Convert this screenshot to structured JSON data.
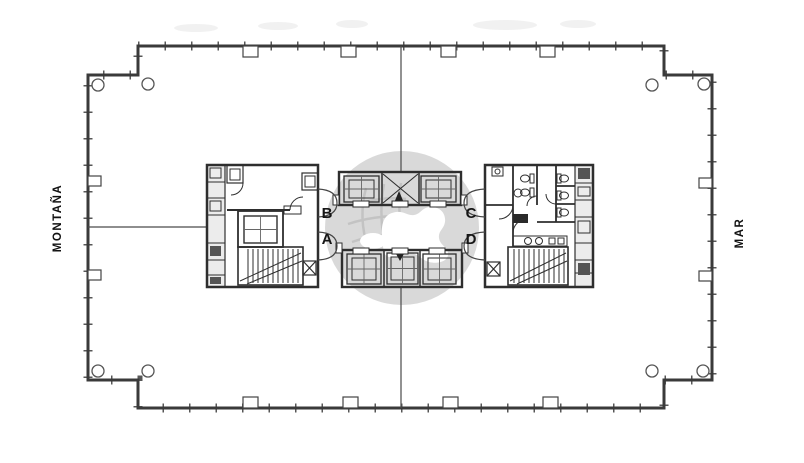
{
  "plan": {
    "orientation_labels": {
      "left": "MONTAÑA",
      "right": "MAR"
    },
    "unit_labels": {
      "b": "B",
      "a": "A",
      "c": "C",
      "d": "D"
    },
    "colors": {
      "wall": "#3a3a3a",
      "detail_line": "#4a4a4a",
      "watermark_gray": "#d9d9d9",
      "watermark_grid": "#c3c3c3"
    }
  }
}
